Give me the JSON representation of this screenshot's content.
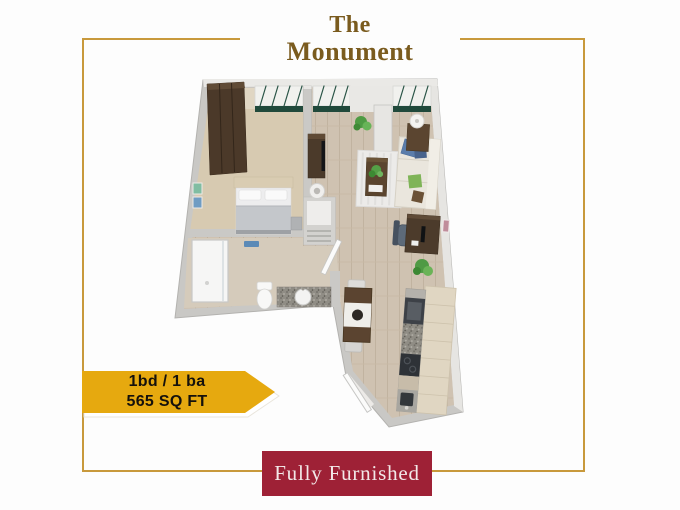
{
  "page": {
    "background_color": "#fdfdfd"
  },
  "frame": {
    "border_color": "#c8993c"
  },
  "header": {
    "title_line1": "The",
    "title_line2": "Monument",
    "title_color": "#7a5b1e"
  },
  "badge": {
    "line1": "1bd / 1 ba",
    "line2": "565 SQ FT",
    "background_color": "#e6a90f",
    "text_color": "#15110c"
  },
  "footer_banner": {
    "label": "Fully Furnished",
    "background_color": "#9e2136",
    "text_color": "#f2e8e8"
  },
  "floorplan": {
    "description": "3D top-down floor plan of a fully furnished one-bedroom apartment",
    "rooms": [
      "bedroom",
      "living-room",
      "bathroom",
      "kitchen",
      "dining-area",
      "entry"
    ],
    "furniture": [
      "wardrobe",
      "bed",
      "wall-art",
      "windows",
      "tv-stand",
      "round-stool",
      "sofa",
      "throw-pillows",
      "area-rug",
      "coffee-table",
      "floor-lamp",
      "side-table",
      "desk",
      "office-chair",
      "plants",
      "shower",
      "towel-rack",
      "toilet",
      "sink-vanity",
      "shelf-closet",
      "bathroom-door",
      "dining-table",
      "dining-chairs",
      "kitchen-cabinets",
      "oven",
      "cooktop",
      "kitchen-sink",
      "entry-door"
    ],
    "palette": {
      "walls": "#c9c8c5",
      "wood_floor": "#cfc2b1",
      "carpet": "#d7cab1",
      "cabinet_wood": "#e0d6c2",
      "dark_wood": "#4b3a2a",
      "sofa_cream": "#eae6dd",
      "accent_blue": "#5b7dab",
      "accent_green": "#5fae4a",
      "window_green": "#20493b",
      "granite": "#908d85"
    }
  }
}
